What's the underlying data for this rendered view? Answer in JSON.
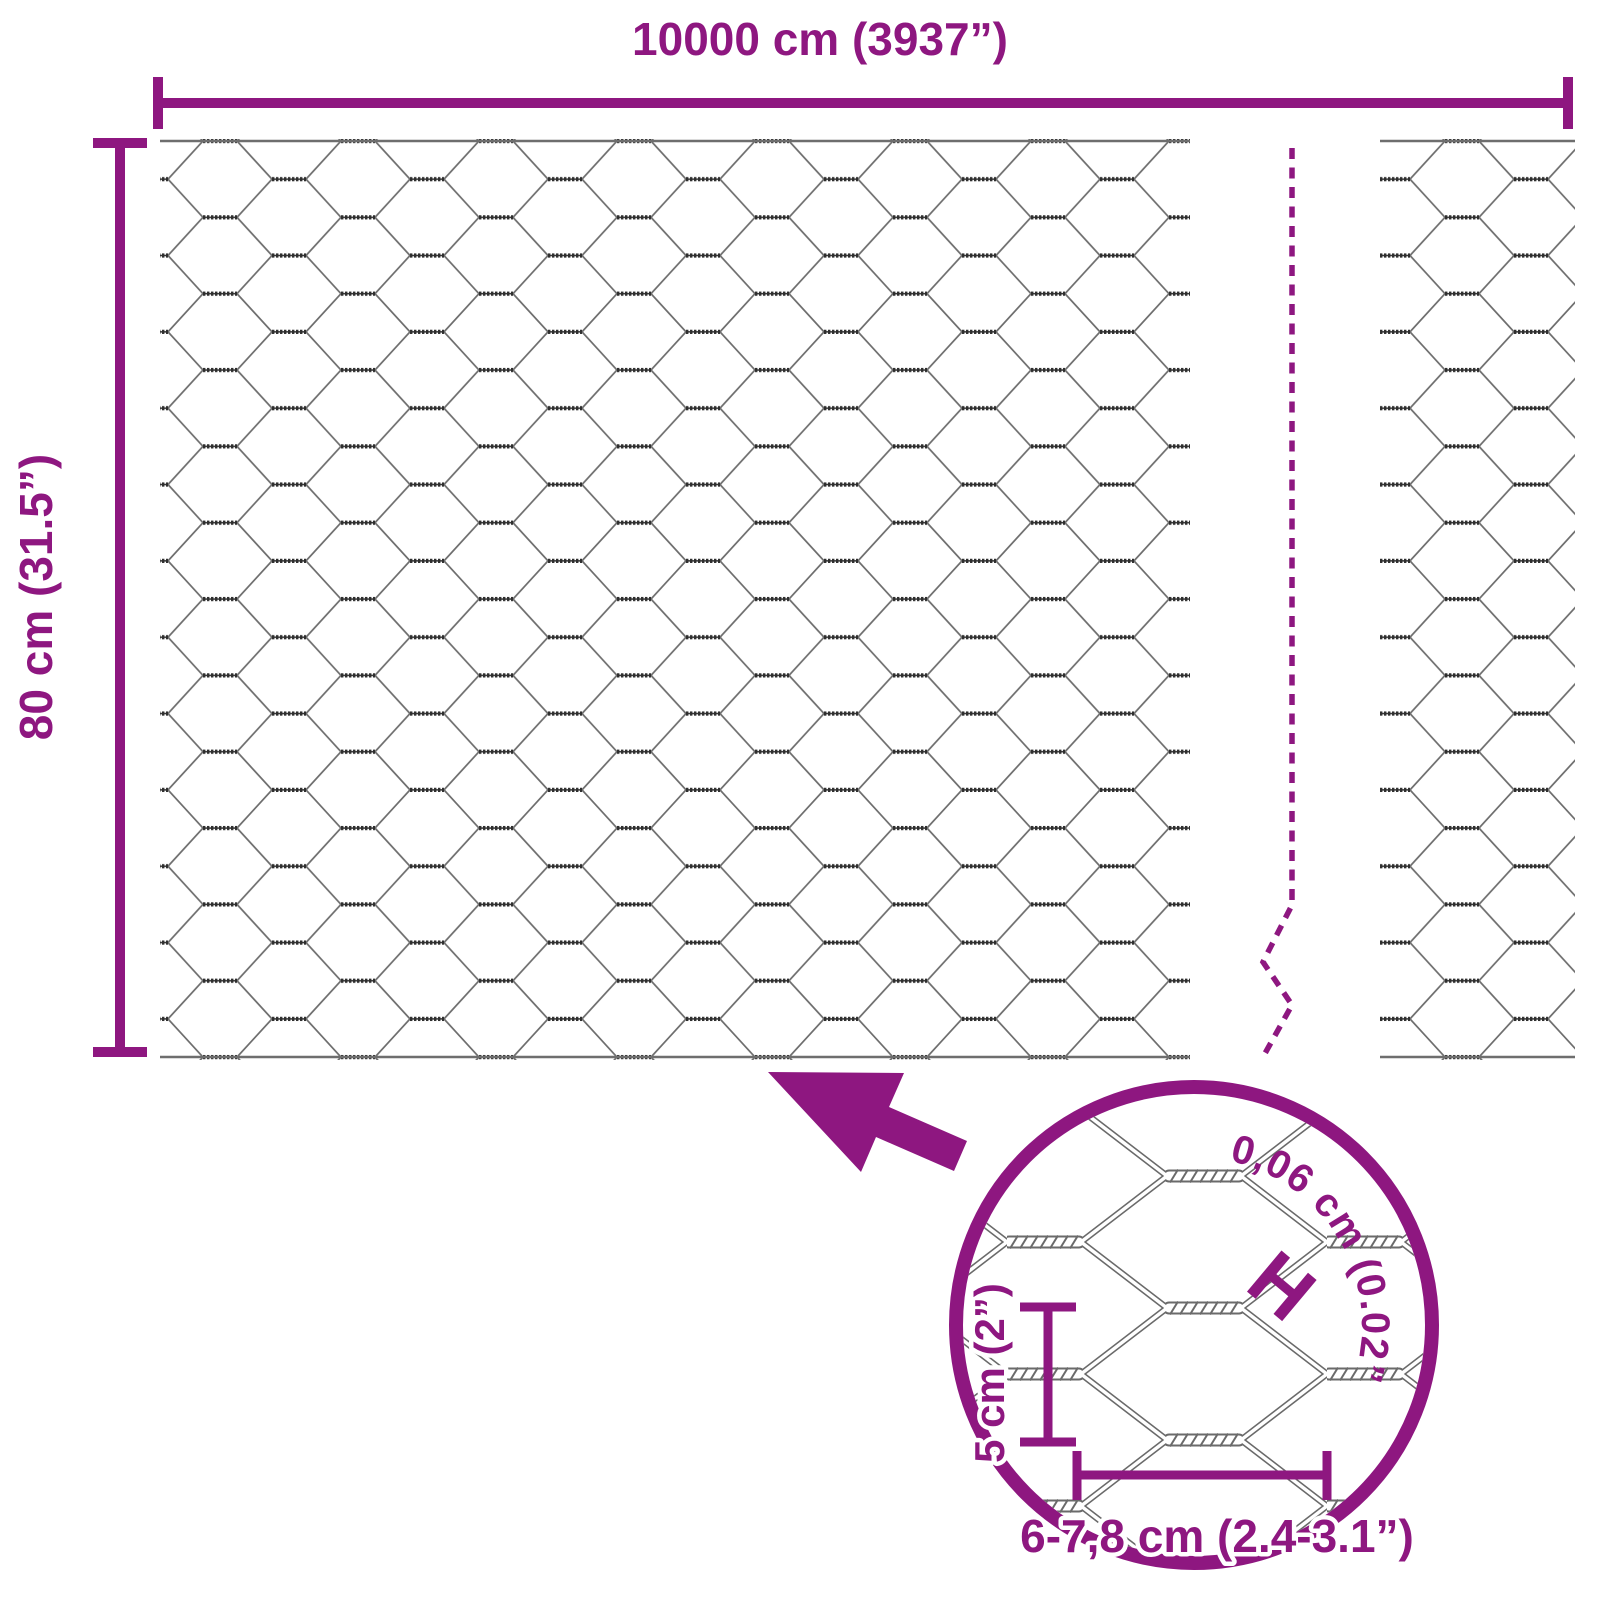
{
  "diagram": {
    "type": "product-dimension-diagram",
    "subject": "hexagonal-wire-mesh-roll",
    "colors": {
      "accent": "#8e1780",
      "wire_gray": "#6e6e6e",
      "wire_dark": "#2f2f2f",
      "background": "#ffffff"
    },
    "dimensions": {
      "width_label": "10000 cm (3937”)",
      "height_label": "80 cm (31.5”)"
    },
    "detail": {
      "wire_thickness_label": "0,06 cm (0.02”)",
      "cell_height_label": "5 cm (2”)",
      "cell_width_label": "6-7,8 cm (2.4-3.1”)",
      "thickness_marker": "H"
    }
  }
}
